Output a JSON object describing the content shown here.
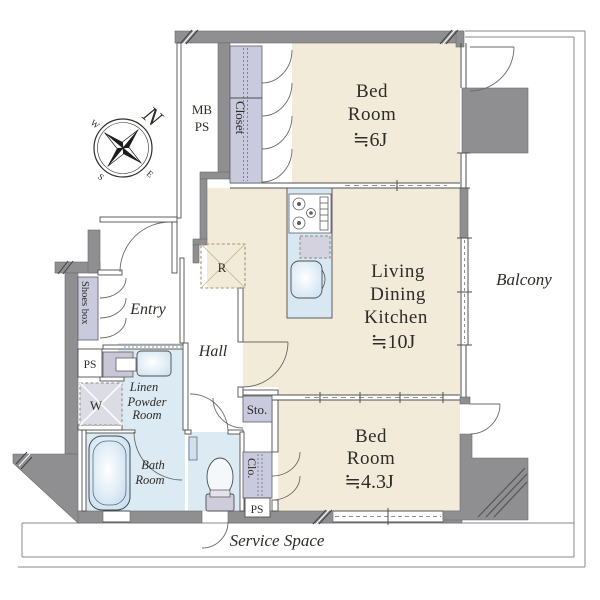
{
  "colors": {
    "room_beige": "#f2ebd9",
    "wet_blue": "#dceaf3",
    "storage_lavender": "#c9cade",
    "wall_gray": "#8f8f92",
    "fixture_gray": "#c9c7d6",
    "sink_blue": "#cfe3f1",
    "text": "#2e2c28",
    "dash_brown": "#a6936f"
  },
  "labels": {
    "bedroom1": {
      "l1": "Bed",
      "l2": "Room",
      "size": "≒6J"
    },
    "ldk": {
      "l1": "Living",
      "l2": "Dining",
      "l3": "Kitchen",
      "size": "≒10J"
    },
    "bedroom2": {
      "l1": "Bed",
      "l2": "Room",
      "size": "≒4.3J"
    },
    "balcony": "Balcony",
    "service_space": "Service Space",
    "entry": "Entry",
    "hall": "Hall",
    "bath": {
      "l1": "Bath",
      "l2": "Room"
    },
    "powder": {
      "l1": "Linen",
      "l2": "Powder",
      "l3": "Room"
    },
    "closet": "Closet",
    "shoes_box": "Shoes box",
    "mb_ps": {
      "l1": "MB",
      "l2": "PS"
    },
    "ps_top": "PS",
    "ps_bottom": "PS",
    "sto": "Sto.",
    "clo": "Clo.",
    "washer": "W",
    "refrigerator": "R",
    "compass": {
      "n": "N",
      "e": "E",
      "s": "S",
      "w": "W"
    }
  }
}
